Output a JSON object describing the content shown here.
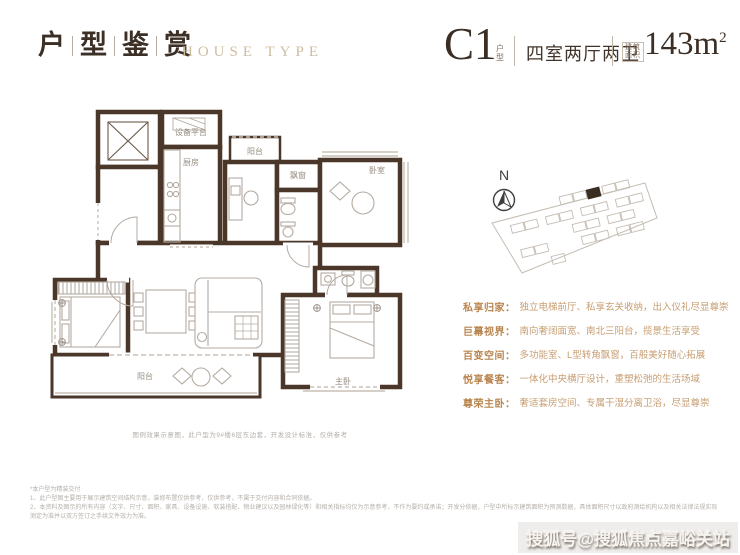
{
  "header": {
    "title_chars": [
      "户",
      "型",
      "鉴",
      "赏"
    ],
    "subtitle": "HOUSE TYPE",
    "unit": {
      "code": "C1",
      "code_label_top": "户",
      "code_label_bottom": "型",
      "layout": "四室两厅两卫",
      "area_label_top": "建筑",
      "area_label_bottom": "面积",
      "area": "143m",
      "area_sup": "2"
    }
  },
  "compass": {
    "north_label": "N"
  },
  "floorplan": {
    "labels": {
      "equipment_platform": "设备平台",
      "kitchen": "厨房",
      "north_balcony": "阳台",
      "bay_window": "飘窗",
      "bedroom": "卧室",
      "south_balcony": "阳台",
      "master_bedroom": "主卧"
    },
    "note": "图例效果示意图，此户型为9#楼6层东边套，开发设计标准，仅供参考"
  },
  "features": [
    {
      "label": "私享归家：",
      "desc": "独立电梯前厅、私享玄关收纳，出入仪礼尽显尊崇"
    },
    {
      "label": "巨幕视界：",
      "desc": "南向奢阔面宽、南北三阳台，揽景生活享受"
    },
    {
      "label": "百变空间：",
      "desc": "多功能室、L型转角飘窗，百般美好随心拓展"
    },
    {
      "label": "悦享餐客：",
      "desc": "一体化中央横厅设计，重塑松弛的生活场域"
    },
    {
      "label": "尊荣主卧：",
      "desc": "奢适套房空间、专属干湿分离卫浴，尽显尊崇"
    }
  ],
  "disclaimer": {
    "intro": "*本户型为精装交付",
    "item1": "1、此户型图主要用于展示建筑空间结构示意，装修布置仅供参考，仅供参考，不属于交付内容和合同依据。",
    "item2": "2、本资料及图示的所有内容（文字、尺寸、面积、家具、设备设施、软装搭配、物业建议以及园林绿化等）和相关指标均仅为示意参考，不作为要约或承诺；开发分依据，户型中所标示建筑面积为预测数据，具体面积尺寸以政府测绘机构以及相关法律法规实际测定为准并以双方签订之手续文件效力为准。"
  },
  "watermark": "搜狐号@搜狐焦点嘉峪关站",
  "colors": {
    "wall": "#4a3729",
    "title": "#3b2f26",
    "tan": "#cdbda0",
    "feature_label": "#b9854f",
    "feature_desc": "#c79e72"
  }
}
